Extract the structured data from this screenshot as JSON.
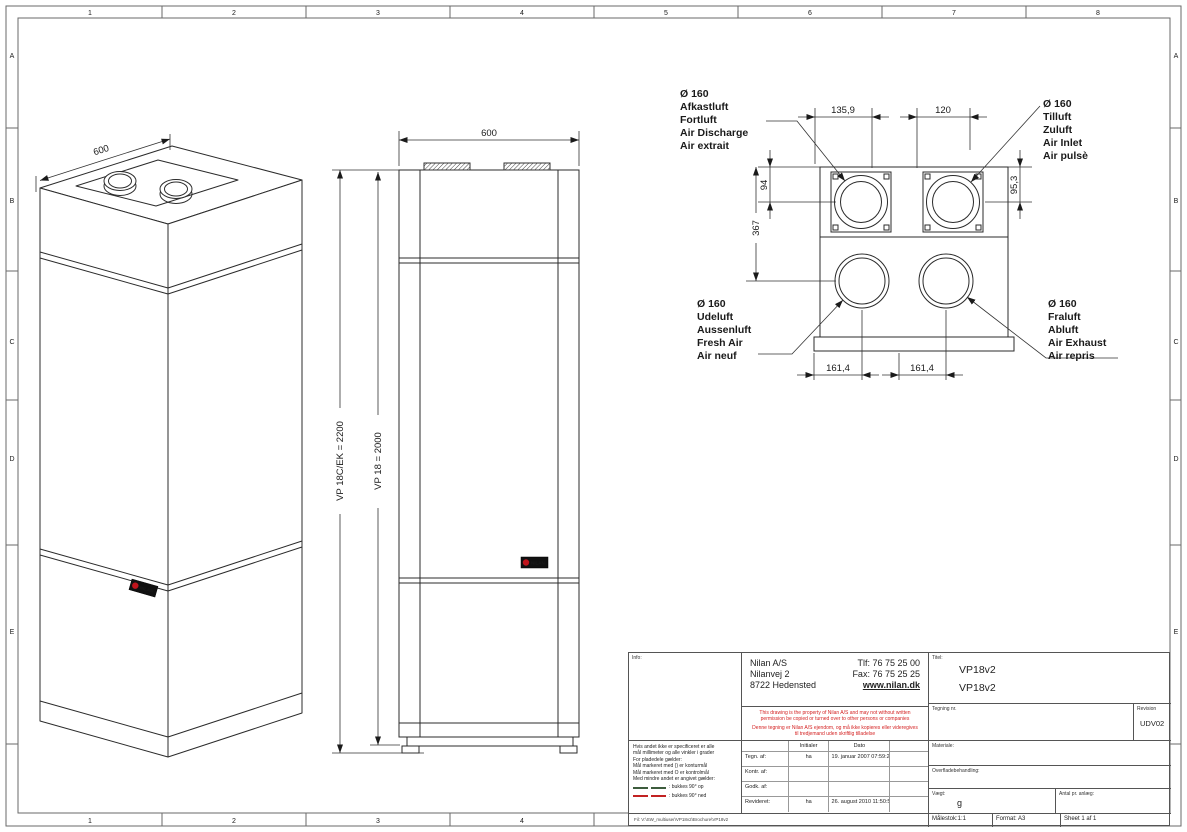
{
  "frame": {
    "top_cols": [
      "1",
      "2",
      "3",
      "4",
      "5",
      "6",
      "7",
      "8"
    ],
    "bottom_cols": [
      "1",
      "2",
      "3",
      "4"
    ],
    "rows": [
      "A",
      "B",
      "C",
      "D",
      "E"
    ]
  },
  "logo_text": "NILAN",
  "iso_view": {
    "width_dim": "600"
  },
  "front_view": {
    "width_dim": "600",
    "height_dim_outer": "VP 18C/EK = 2200",
    "height_dim_inner": "VP 18 = 2000"
  },
  "top_view": {
    "dims": {
      "top_left": "135,9",
      "top_right": "120",
      "left_upper": "94",
      "left_lower": "367",
      "right_side": "95,3",
      "bottom_left": "161,4",
      "bottom_right": "161,4"
    },
    "port_labels": {
      "discharge": [
        "Ø 160",
        "Afkastluft",
        "Fortluft",
        "Air Discharge",
        "Air extrait"
      ],
      "inlet": [
        "Ø 160",
        "Tilluft",
        "Zuluft",
        "Air Inlet",
        "Air pulsè"
      ],
      "fresh": [
        "Ø 160",
        "Udeluft",
        "Aussenluft",
        "Fresh Air",
        "Air neuf"
      ],
      "exhaust": [
        "Ø 160",
        "Fraluft",
        "Abluft",
        "Air Exhaust",
        "Air repris"
      ]
    }
  },
  "title_block": {
    "info_label": "Info:",
    "company": {
      "name": "Nilan A/S",
      "street": "Nilanvej 2",
      "city": "8722 Hedensted",
      "phone": "Tlf: 76 75 25 00",
      "fax": "Fax: 76 75 25 25",
      "web": "www.nilan.dk"
    },
    "disclaimer_en": "This drawing is the property of Nilan A/S and may not without written permission be copied or turned over to other persons or companies",
    "disclaimer_da": "Denne tegning er Nilan A/S ejendom, og må ikke kopieres eller videregives til tredjemand uden skriftlig tilladelse",
    "titel_label": "Titel:",
    "title_line1": "VP18v2",
    "title_line2": "VP18v2",
    "tegning_label": "Tegning nr.",
    "revision_label": "Revision",
    "revision_value": "UDV02",
    "materiale_label": "Materiale:",
    "overflade_label": "Overfladebehandling:",
    "vaegt_label": "Vægt:",
    "vaegt_value": "g",
    "antal_label": "Antal pr. anlæg:",
    "maalestok": "Målestok:1:1",
    "format": "Format: A3",
    "sheet": "Sheet 1 af 1",
    "file_path": "Fil: V:\\SW_multiuser\\VP18v2\\Brochure\\VP18v2",
    "notes": {
      "line1": "Hvis andet ikke er specificeret er alle",
      "line2": "mål millimeter og alle vinkler i grader",
      "line3": "For pladedele gælder:",
      "line4": "Mål markeret med () er konturmål",
      "line5": "Mål markeret med O er kontrolmål",
      "line6": "Med mindre andet er angivet gælder:",
      "legend_up": ": bukkes 90° op",
      "legend_down": ": bukkes 90° ned"
    },
    "table": {
      "col_initialer": "Initialer",
      "col_dato": "Dato",
      "rows": [
        {
          "label": "Tegn. af:",
          "init": "ha",
          "date": "19. januar 2007 07:59:20"
        },
        {
          "label": "Kontr. af:",
          "init": "",
          "date": ""
        },
        {
          "label": "Godk. af:",
          "init": "",
          "date": ""
        },
        {
          "label": "Revideret:",
          "init": "ha",
          "date": "26. august 2010 11:50:56"
        }
      ]
    }
  }
}
